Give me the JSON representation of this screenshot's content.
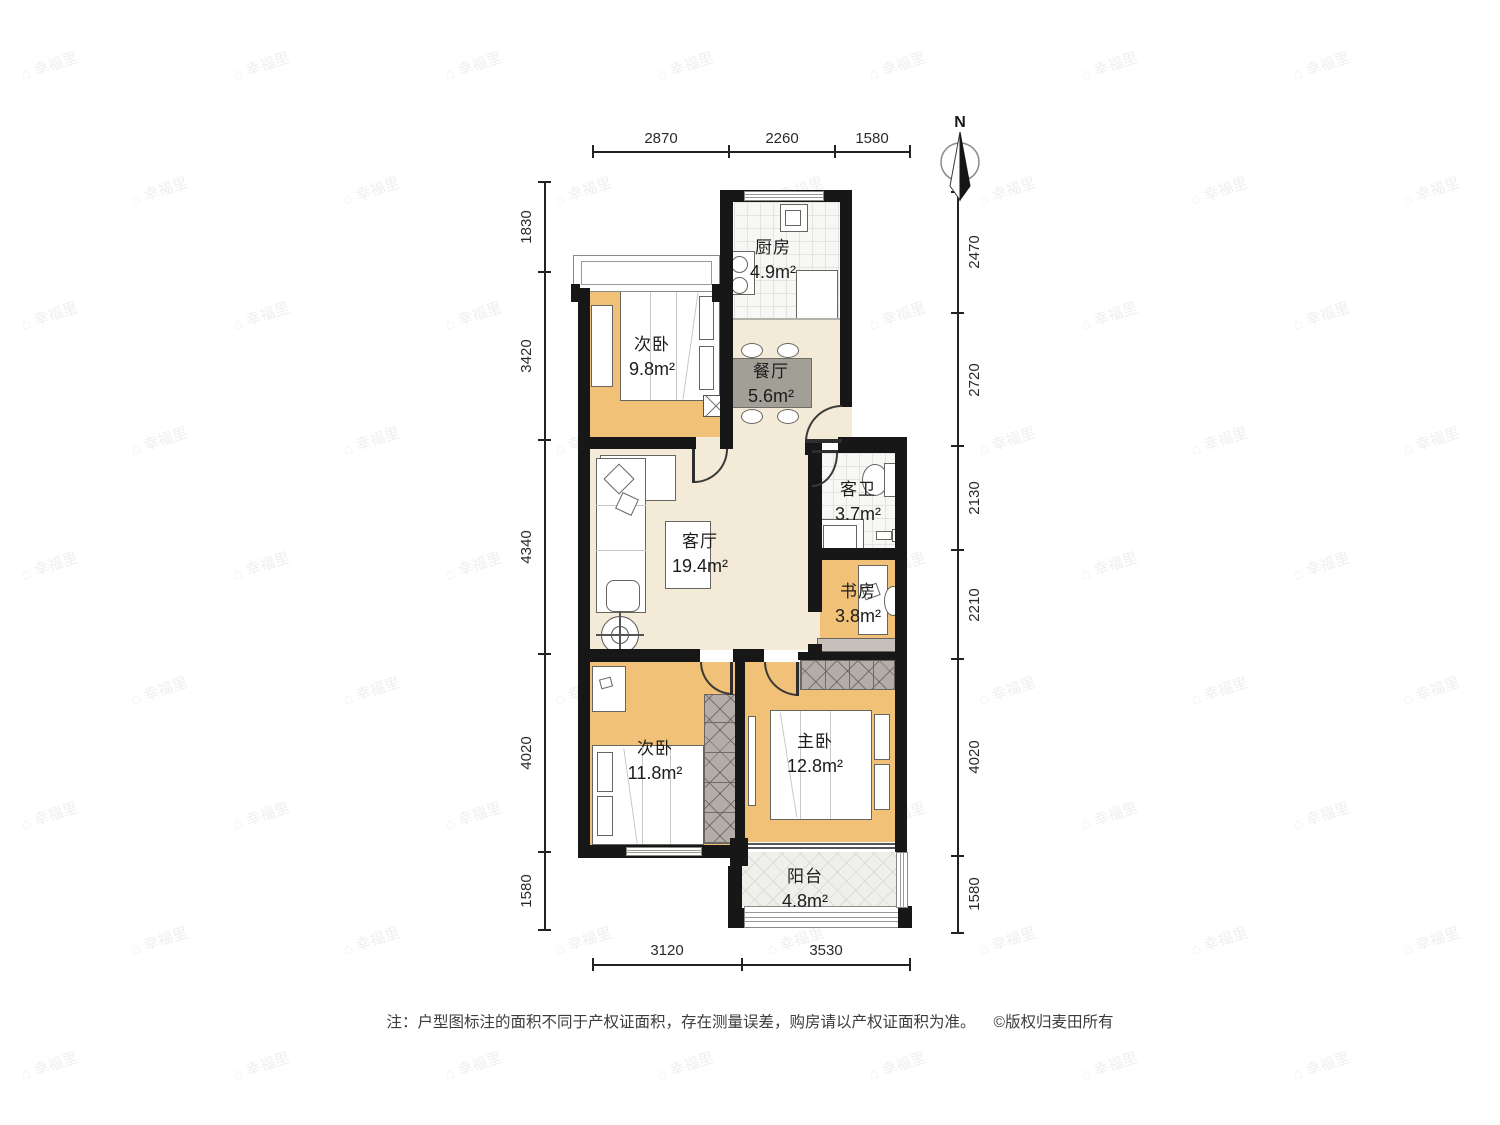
{
  "rooms": [
    {
      "id": "kitchen",
      "name": "厨房",
      "area": "4.9m²"
    },
    {
      "id": "dining",
      "name": "餐厅",
      "area": "5.6m²"
    },
    {
      "id": "bedroom-small",
      "name": "次卧",
      "area": "9.8m²"
    },
    {
      "id": "guest-bath",
      "name": "客卫",
      "area": "3.7m²"
    },
    {
      "id": "living",
      "name": "客厅",
      "area": "19.4m²"
    },
    {
      "id": "study",
      "name": "书房",
      "area": "3.8m²"
    },
    {
      "id": "bedroom-mid",
      "name": "次卧",
      "area": "11.8m²"
    },
    {
      "id": "master",
      "name": "主卧",
      "area": "12.8m²"
    },
    {
      "id": "balcony",
      "name": "阳台",
      "area": "4.8m²"
    }
  ],
  "dimensions": {
    "top": [
      "2870",
      "2260",
      "1580"
    ],
    "bottom": [
      "3120",
      "3530"
    ],
    "left": [
      "1830",
      "3420",
      "4340",
      "4020",
      "1580"
    ],
    "right": [
      "2470",
      "2720",
      "2130",
      "2210",
      "4020",
      "1580"
    ]
  },
  "compass": {
    "north_label": "N"
  },
  "footer": {
    "note": "注：户型图标注的面积不同于产权证面积，存在测量误差，购房请以产权证面积为准。",
    "copyright": "©版权归麦田所有"
  },
  "watermark": {
    "text": "幸福里"
  },
  "colors": {
    "wall": "#171717",
    "bedroom_floor": "#f0c176",
    "living_floor": "#f3ead7",
    "tile_floor": "#f7f7f5",
    "wardrobe": "#b4ada7",
    "dining_table": "#a29f97"
  }
}
